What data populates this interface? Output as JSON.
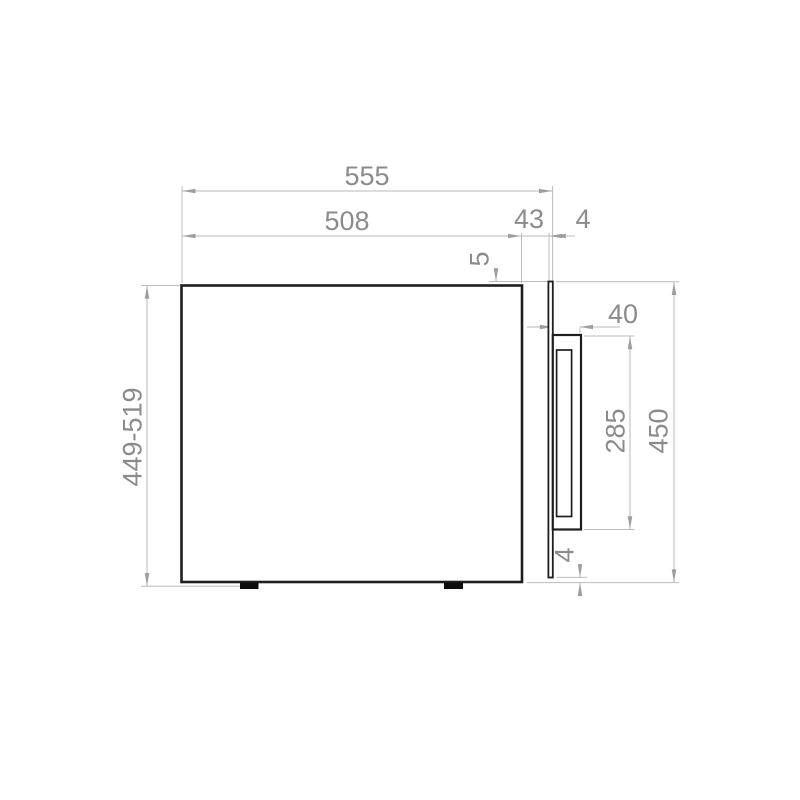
{
  "drawing": {
    "type": "technical-dimension-drawing",
    "subject": "built-in appliance side elevation with door and handle",
    "unit": "mm",
    "background_color": "#ffffff",
    "colors": {
      "object_line": "#1e1e1e",
      "foot_fill": "#0d0d0d",
      "dimension_line": "#bcbcbc",
      "arrow": "#9e9e9e",
      "dimension_text": "#8b8b8b"
    },
    "dimensions": {
      "overall_depth": "555",
      "body_depth": "508",
      "door_clearance": "43",
      "door_panel_thickness": "4",
      "top_panel_offset": "5",
      "handle_depth": "40",
      "handle_height": "285",
      "overall_height": "450",
      "bottom_panel_offset": "4",
      "adjustable_height_range": "449-519"
    }
  }
}
